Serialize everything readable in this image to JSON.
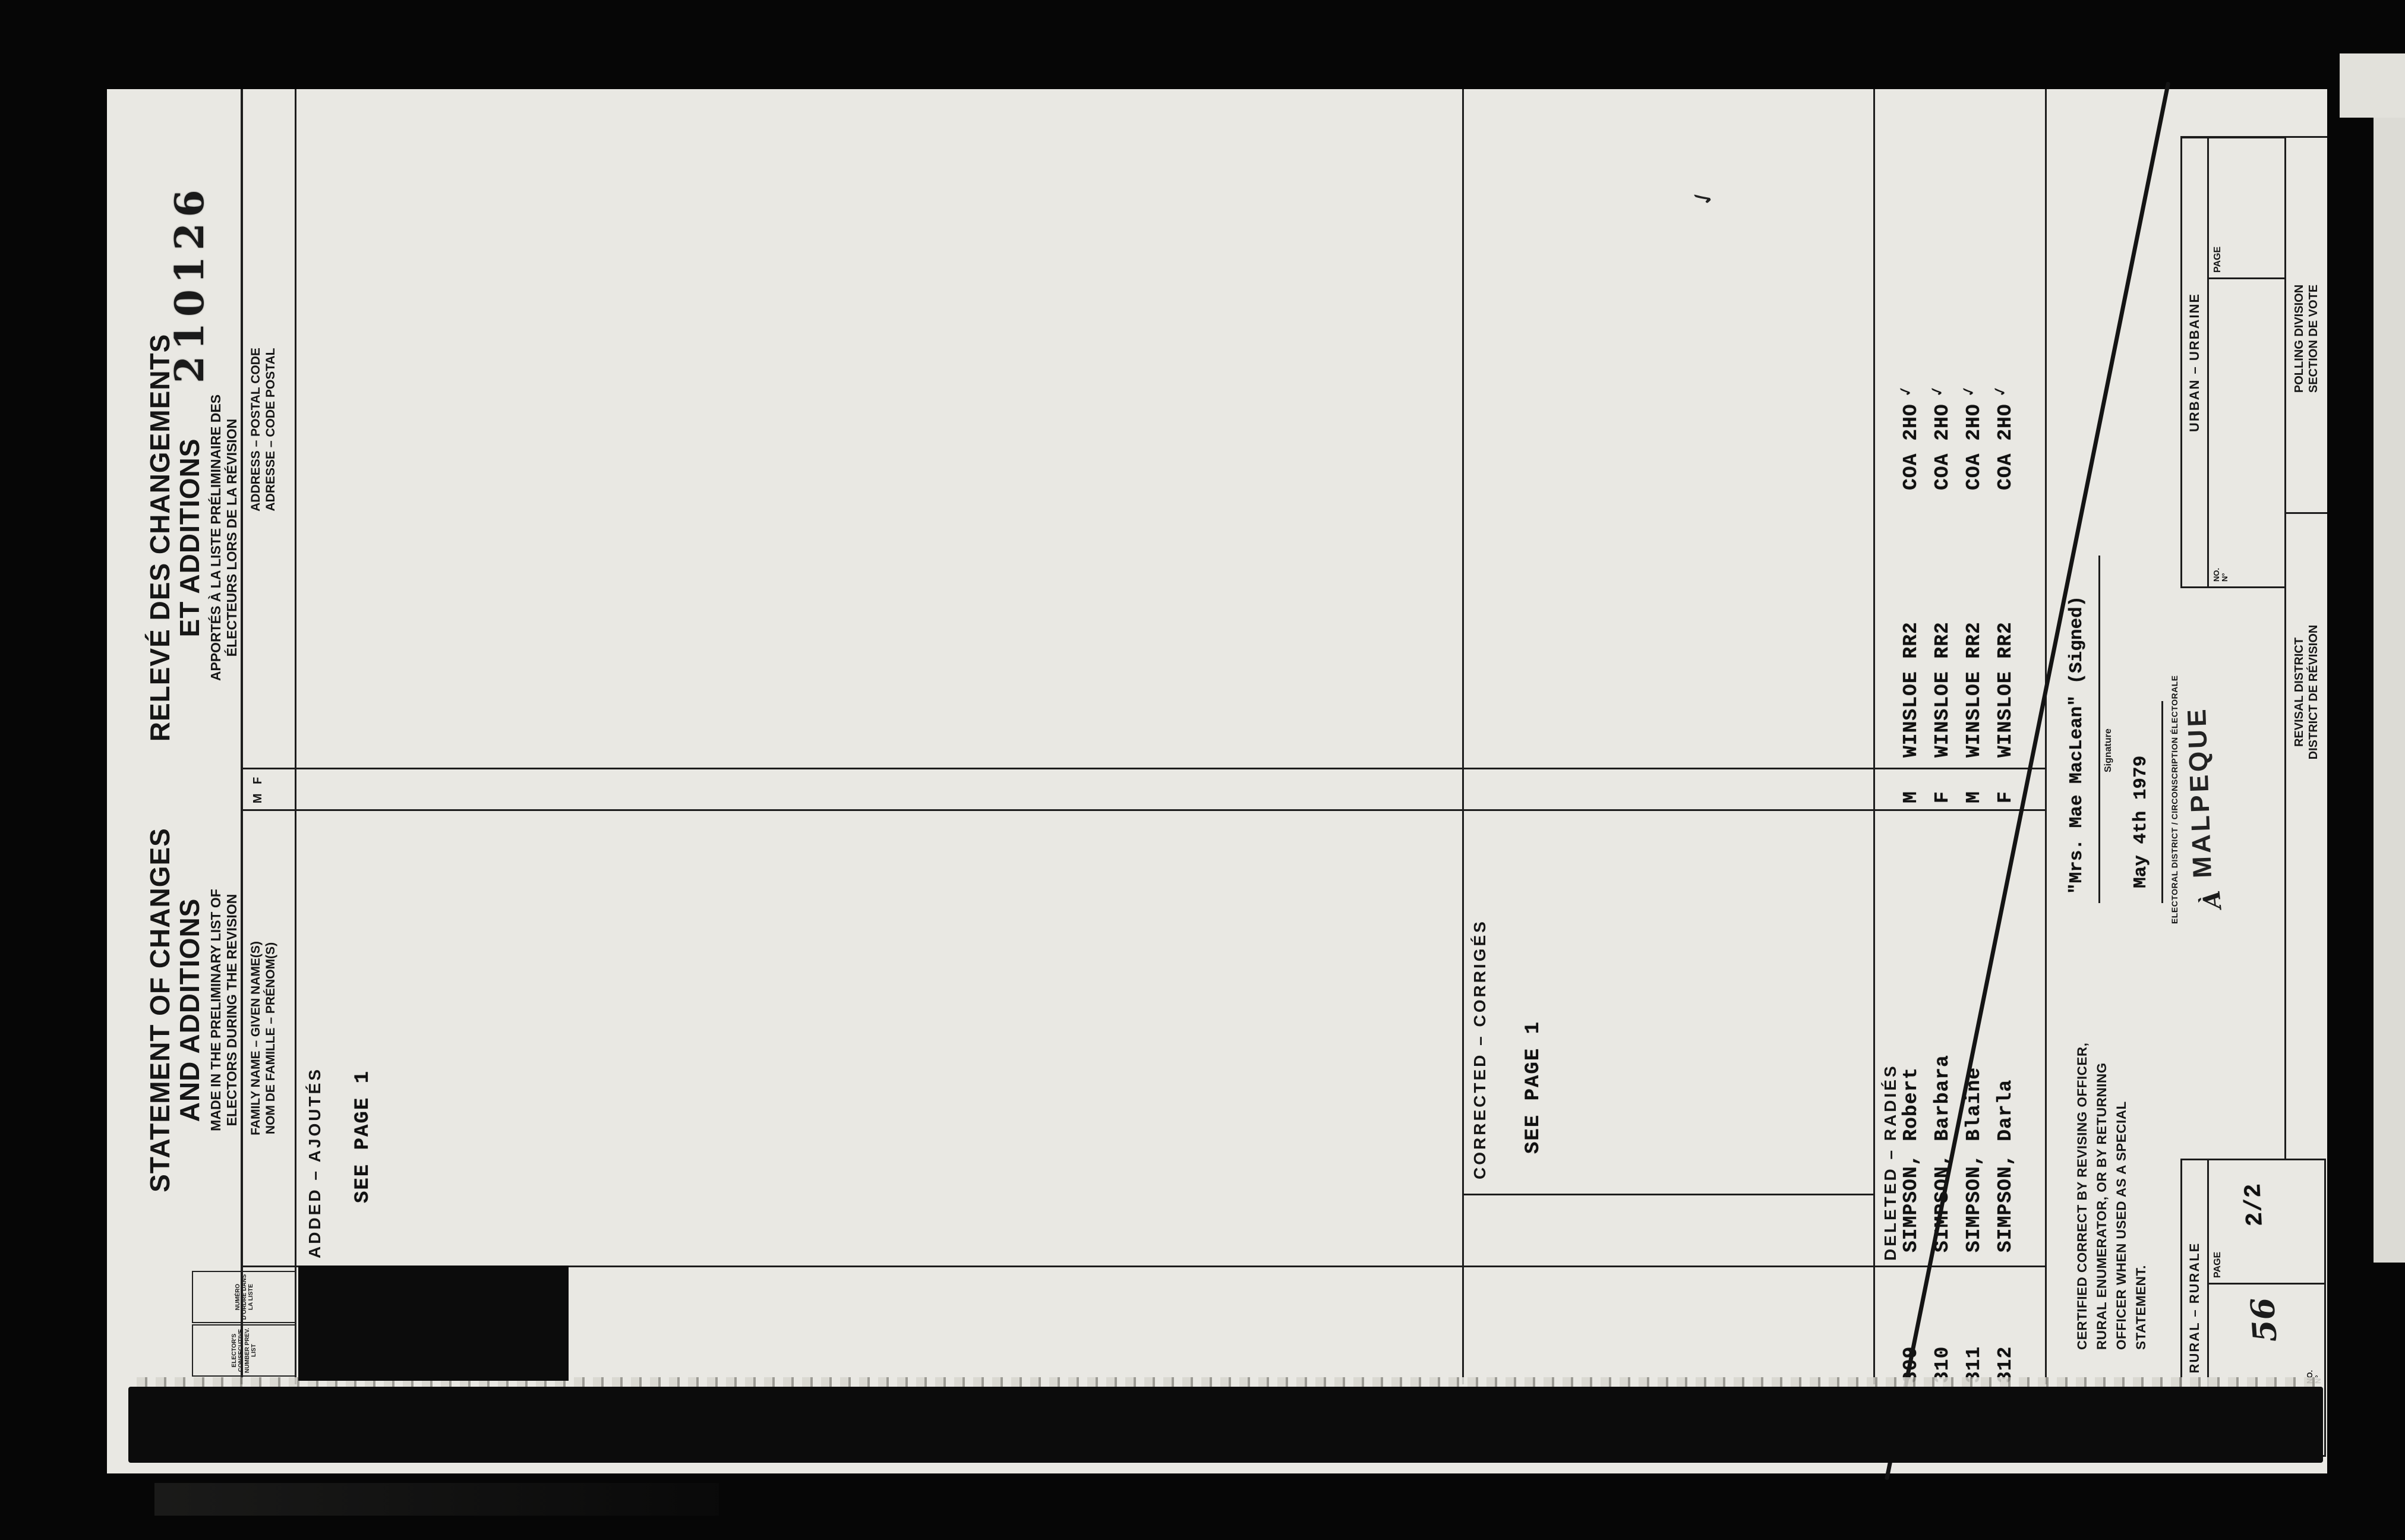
{
  "stamp_number": "210126",
  "tick_mark": "✓",
  "titles": {
    "en": {
      "line1": "STATEMENT OF CHANGES",
      "line2": "AND ADDITIONS",
      "sub1": "MADE IN THE PRELIMINARY LIST OF",
      "sub2": "ELECTORS DURING THE REVISION"
    },
    "fr": {
      "line1": "RELEVÉ DES CHANGEMENTS",
      "line2": "ET ADDITIONS",
      "sub1": "APPORTÉS À LA LISTE PRÉLIMINAIRE DES",
      "sub2": "ÉLECTEURS LORS DE LA RÉVISION"
    }
  },
  "table": {
    "no_box_en": "ELECTOR'S CONSECUTIVE NUMBER PREV. LIST",
    "no_box_fr": "NUMÉRO D'ORDRE DANS LA LISTE",
    "name_header_en": "FAMILY NAME – GIVEN NAME(S)",
    "name_header_fr": "NOM DE FAMILLE – PRÉNOM(S)",
    "sex_m": "M",
    "sex_f": "F",
    "address_header_en": "ADDRESS – POSTAL CODE",
    "address_header_fr": "ADRESSE – CODE POSTAL"
  },
  "sections": {
    "added": {
      "label": "ADDED – AJOUTÉS",
      "note": "SEE PAGE 1"
    },
    "corrected": {
      "label": "CORRECTED – CORRIGÉS",
      "note": "SEE PAGE 1"
    },
    "deleted": {
      "label": "DELETED – RADIÉS",
      "rows": [
        {
          "no": "309",
          "name": "SIMPSON, Robert",
          "sex": "M",
          "address": "WINSLOE RR2",
          "postal": "COA 2HO",
          "check": "✓"
        },
        {
          "no": "310",
          "name": "SIMPSON, Barbara",
          "sex": "F",
          "address": "WINSLOE RR2",
          "postal": "COA 2HO",
          "check": "✓"
        },
        {
          "no": "311",
          "name": "SIMPSON, Blaine",
          "sex": "M",
          "address": "WINSLOE RR2",
          "postal": "COA 2HO",
          "check": "✓"
        },
        {
          "no": "312",
          "name": "SIMPSON, Darla",
          "sex": "F",
          "address": "WINSLOE RR2",
          "postal": "COA 2HO",
          "check": "✓"
        }
      ]
    }
  },
  "footer": {
    "certification": [
      "CERTIFIED CORRECT BY REVISING OFFICER,",
      "RURAL ENUMERATOR, OR BY RETURNING",
      "OFFICER WHEN USED AS A SPECIAL",
      "STATEMENT."
    ],
    "signature_value": "\"Mrs. Mae MacLean\" (Signed)",
    "signature_label": "Signature",
    "date_value": "May 4th 1979",
    "district_label": "ELECTORAL DISTRICT / CIRCONSCRIPTION ÉLECTORALE",
    "district_prefix": "À",
    "district_value": "MALPEQUE",
    "rural": {
      "label": "RURAL – RURALE",
      "no_label": "NO.",
      "no_label_fr": "N°",
      "no_value": "56",
      "page_label": "PAGE",
      "page_value": "2/2"
    },
    "urban": {
      "label": "URBAN – URBAINE",
      "no_label": "NO.",
      "no_label_fr": "N°",
      "page_label": "PAGE"
    },
    "revisal_district": {
      "en": "REVISAL DISTRICT",
      "fr": "DISTRICT DE RÉVISION"
    },
    "polling_division": {
      "en": "POLLING DIVISION",
      "fr": "SECTION DE VOTE"
    }
  }
}
